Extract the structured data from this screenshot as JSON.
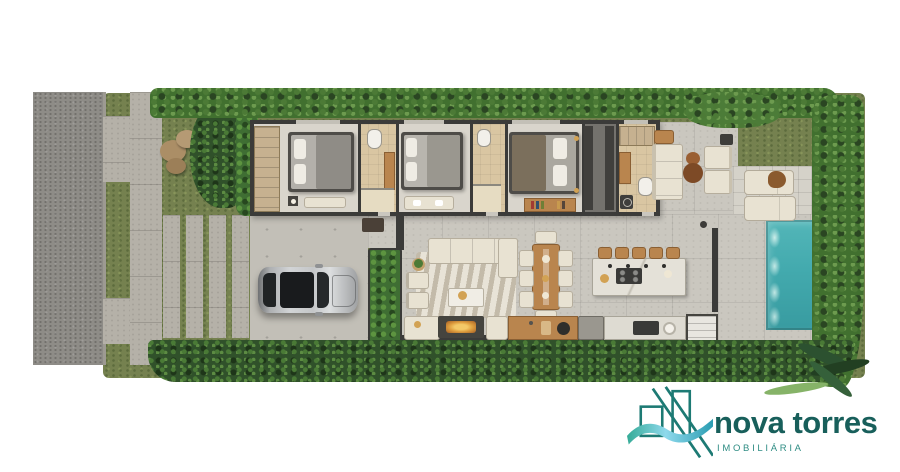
{
  "brand": {
    "name": "nova torres",
    "tagline": "IMOBILIÁRIA",
    "colors": {
      "wordmark": "#185f5b",
      "tagline": "#2f8d84",
      "wave_start": "#35ab97",
      "wave_mid": "#8ed9ec",
      "wave_end": "#2b9db2",
      "mark_stroke": "#1d7a74"
    }
  },
  "scene": {
    "palette": {
      "grass": "#75814f",
      "hedge": "#41702f",
      "hedgedark": "#2a4522",
      "shrub": "#30512a",
      "leaf": "#4c7a36",
      "road": "#8e8c87",
      "sidewalk": "#b5b1a8",
      "concrete": "#c2bfb7",
      "slab": "#cac7bf",
      "paver": "#d5d2c9",
      "floor": "#d9d5cc",
      "bath": "#d9c6a2",
      "wall": "#3b3b39",
      "wood": "#b9854e",
      "cream": "#e8e2d2",
      "marble": "#e4e1d8",
      "water": "#43aaae",
      "gold": "#d2a254",
      "fire": "#df9f3f",
      "car": "#c6c8ca"
    }
  }
}
